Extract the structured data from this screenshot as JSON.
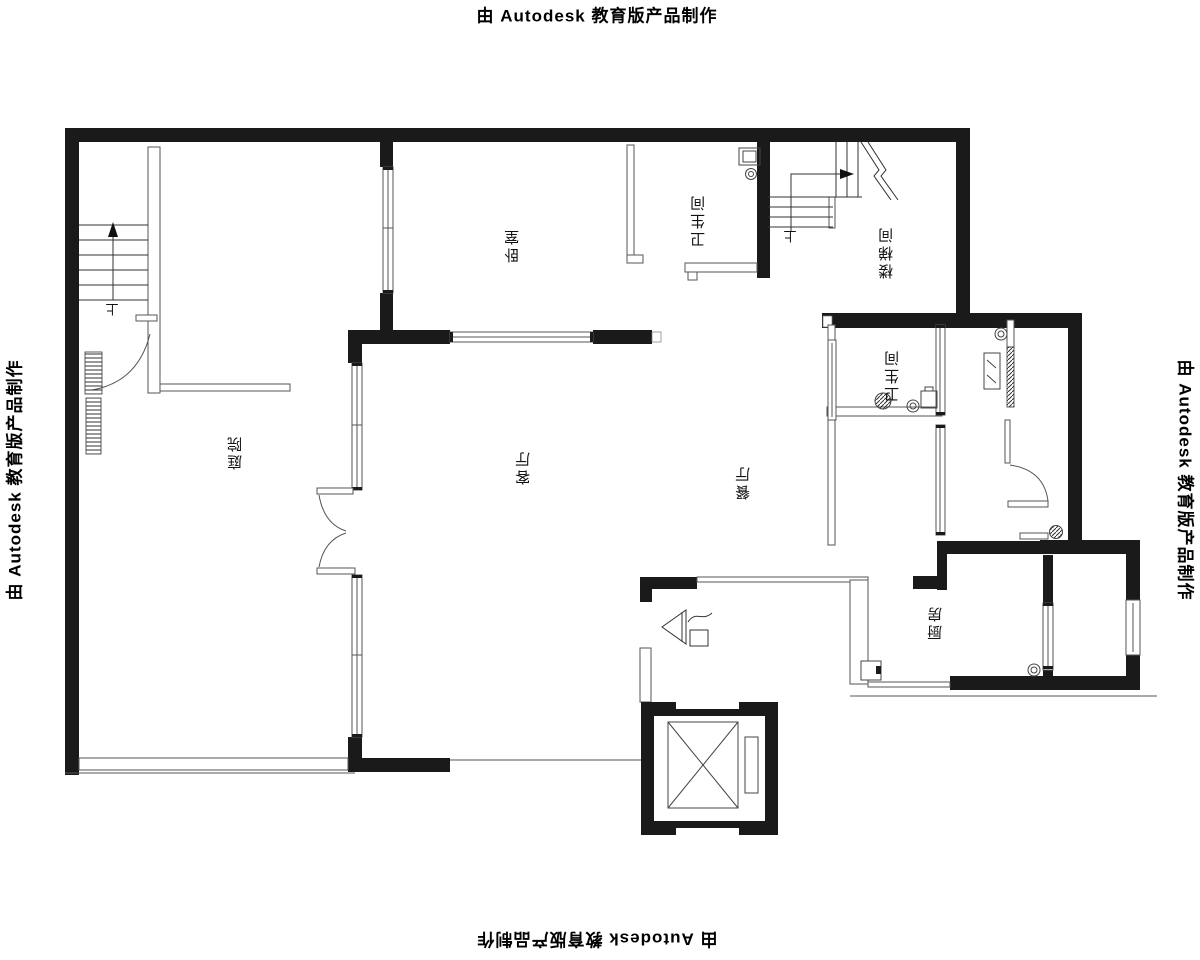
{
  "watermark": {
    "text": "由 Autodesk 教育版产品制作"
  },
  "rooms": {
    "bedroom": {
      "label": "卧室"
    },
    "bathroom_top": {
      "label": "卫生间"
    },
    "stairwell": {
      "label": "楼梯间"
    },
    "courtyard": {
      "label": "庭院"
    },
    "living_room": {
      "label": "客厅"
    },
    "dining_room": {
      "label": "餐厅"
    },
    "bathroom_mid": {
      "label": "卫生间"
    },
    "kitchen": {
      "label": "厨房"
    }
  },
  "stairs": {
    "up_marker": "上"
  },
  "colors": {
    "wall": "#1a1a1a",
    "line": "#555555",
    "background": "#ffffff"
  }
}
